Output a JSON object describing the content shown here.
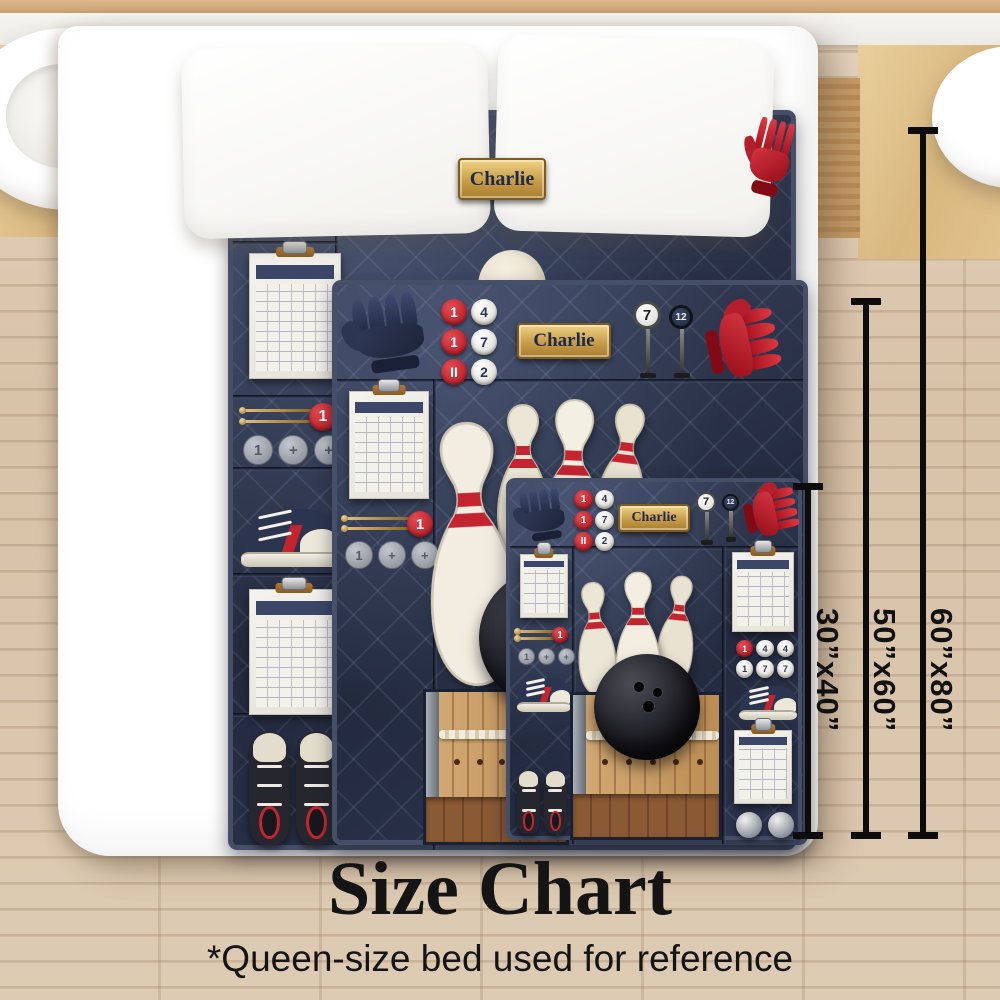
{
  "scene": {
    "title": "Size Chart",
    "footnote": "*Queen-size bed used for reference"
  },
  "sizes": [
    {
      "label": "30”x40”"
    },
    {
      "label": "50”x60”"
    },
    {
      "label": "60”x80”"
    }
  ],
  "quilt": {
    "name": "Charlie",
    "pin_buttons": {
      "red": [
        "1",
        "1",
        "II"
      ],
      "white": [
        "4",
        "7",
        "2"
      ]
    },
    "sign_values": [
      "7",
      "12"
    ],
    "coin_symbols": [
      "1",
      "+",
      "+"
    ],
    "needle_tag": "1",
    "score_buttons": [
      [
        "1",
        "4",
        "4"
      ],
      [
        "1",
        "7",
        "7"
      ]
    ]
  },
  "colors": {
    "quilt_navy": "#2b3349",
    "accent_red": "#c8202a",
    "nameplate_gold": "#c9a050",
    "floor_wood": "#d8c2a8",
    "lane_wood": "#c79c66"
  }
}
